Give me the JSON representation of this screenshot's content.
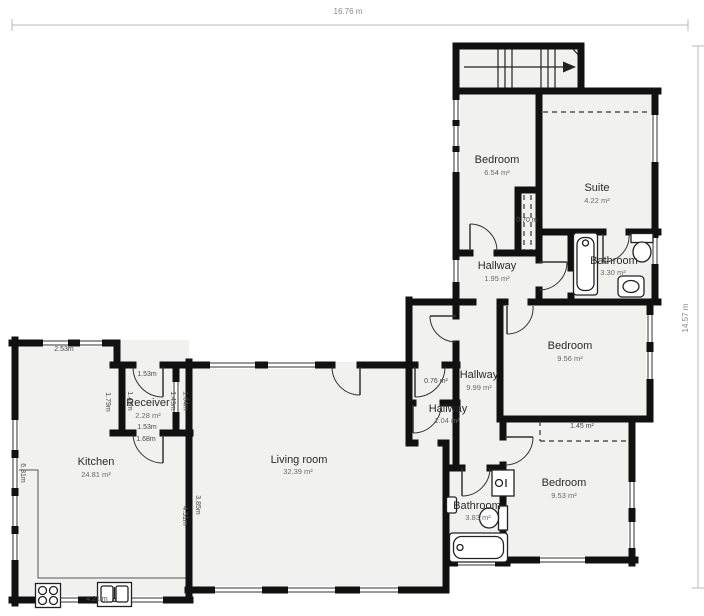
{
  "rulers": {
    "top": "16.76 m",
    "right": "14.57 m"
  },
  "rooms": [
    {
      "name": "Bedroom",
      "area": "6.54 m²"
    },
    {
      "name": "Suite",
      "area": "4.22 m²"
    },
    {
      "name": "Hallway",
      "area": "1.95 m²"
    },
    {
      "name": "Bathroom",
      "area": "3.30 m²"
    },
    {
      "name": "Bedroom",
      "area": "9.56 m²"
    },
    {
      "name": "Hallway",
      "area": "9.99 m²"
    },
    {
      "name": "Hallway",
      "area": "1.04 m²"
    },
    {
      "name": "Bedroom",
      "area": "9.53 m²"
    },
    {
      "name": "Bathroom",
      "area": "3.83 m²"
    },
    {
      "name": "Receiver",
      "area": "2.28 m²"
    },
    {
      "name": "Kitchen",
      "area": "24.81 m²"
    },
    {
      "name": "Living room",
      "area": "32.39 m²"
    }
  ],
  "annotations": {
    "closet_depth": "0.70 m",
    "closet_small": "0.76 m²",
    "wardrobe": "1.45 m²"
  },
  "dimensions": {
    "kitchen_top_width": "2.53m",
    "receiver_top": "1.53m",
    "receiver_left": "1.49m",
    "receiver_right": "1.49m",
    "shaft_height": "1.64m",
    "kitchen_step": "1.79m",
    "receiver_bottom": "1.53m",
    "kitchen_door": "1.68m",
    "kitchen_left": "6.81m",
    "kitchen_right": "4.51m",
    "living_left": "3.85m",
    "kitchen_bottom": "4.21 m"
  },
  "colors": {
    "wall": "#111111",
    "room_fill": "#f1f1ef",
    "ruler": "#bbbbbb"
  }
}
